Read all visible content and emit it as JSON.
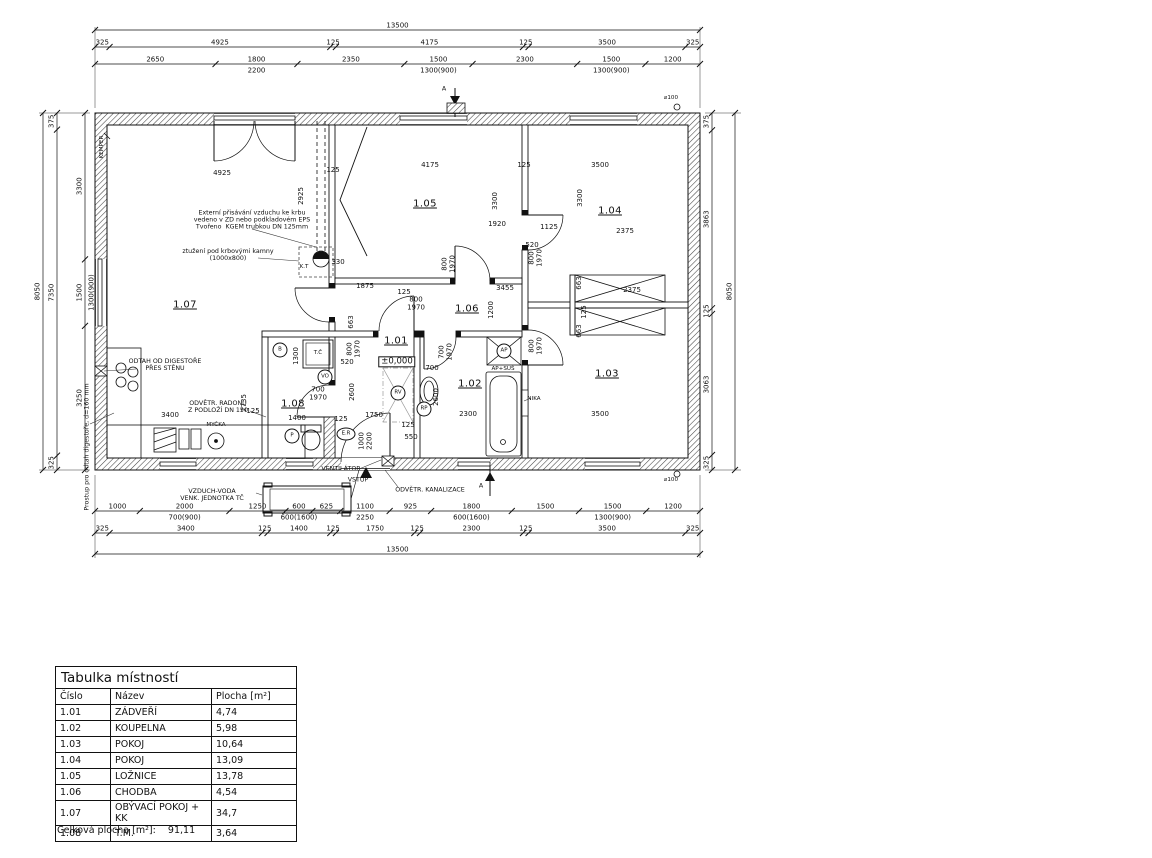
{
  "table": {
    "title": "Tabulka místností",
    "columns": [
      "Číslo",
      "Název",
      "Plocha [m²]"
    ],
    "rows": [
      [
        "1.01",
        "ZÁDVEŘÍ",
        "4,74"
      ],
      [
        "1.02",
        "KOUPELNA",
        "5,98"
      ],
      [
        "1.03",
        "POKOJ",
        "10,64"
      ],
      [
        "1.04",
        "POKOJ",
        "13,09"
      ],
      [
        "1.05",
        "LOŽNICE",
        "13,78"
      ],
      [
        "1.06",
        "CHODBA",
        "4,54"
      ],
      [
        "1.07",
        "OBÝVACÍ POKOJ + KK",
        "34,7"
      ],
      [
        "1.08",
        "T.M.",
        "3,64"
      ]
    ],
    "footer_label": "Celková plocha [m²]:",
    "footer_value": "91,11"
  },
  "drawing": {
    "h_chains": [
      {
        "y": 30,
        "segments": [
          {
            "v": "13500"
          }
        ]
      },
      {
        "y": 47,
        "segments": [
          {
            "v": "325"
          },
          {
            "v": "4925"
          },
          {
            "v": "125"
          },
          {
            "v": "4175"
          },
          {
            "v": "125"
          },
          {
            "v": "3500"
          },
          {
            "v": "325"
          }
        ]
      },
      {
        "y": 64,
        "segments": [
          {
            "v": "2650"
          },
          {
            "v": "1800",
            "sub": "2200"
          },
          {
            "v": "2350"
          },
          {
            "v": "1500",
            "sub": "1300(900)"
          },
          {
            "v": "2300"
          },
          {
            "v": "1500",
            "sub": "1300(900)"
          },
          {
            "v": "1200"
          }
        ]
      },
      {
        "y": 511,
        "segments": [
          {
            "v": "1000"
          },
          {
            "v": "2000",
            "sub": "700(900)"
          },
          {
            "v": "1250"
          },
          {
            "v": "600",
            "sub": "600(1600)"
          },
          {
            "v": "625"
          },
          {
            "v": "1100",
            "sub": "2250"
          },
          {
            "v": "925"
          },
          {
            "v": "1800",
            "sub": "600(1600)"
          },
          {
            "v": "1500"
          },
          {
            "v": "1500",
            "sub": "1300(900)"
          },
          {
            "v": "1200"
          }
        ]
      },
      {
        "y": 533,
        "segments": [
          {
            "v": "325"
          },
          {
            "v": "3400"
          },
          {
            "v": "125"
          },
          {
            "v": "1400"
          },
          {
            "v": "125"
          },
          {
            "v": "1750"
          },
          {
            "v": "125"
          },
          {
            "v": "2300"
          },
          {
            "v": "125"
          },
          {
            "v": "3500"
          },
          {
            "v": "325"
          }
        ]
      },
      {
        "y": 554,
        "segments": [
          {
            "v": "13500"
          }
        ]
      }
    ],
    "v_chains": [
      {
        "x": 43,
        "segments": [
          {
            "v": "8050"
          }
        ]
      },
      {
        "x": 57,
        "segments": [
          {
            "v": "375"
          },
          {
            "v": "7350"
          },
          {
            "v": "325"
          }
        ]
      },
      {
        "x": 85,
        "segments": [
          {
            "v": "3300"
          },
          {
            "v": "1500",
            "sub": "1300(900)"
          },
          {
            "v": "3250"
          }
        ]
      },
      {
        "x": 712,
        "segments": [
          {
            "v": "375"
          },
          {
            "v": "3863"
          },
          {
            "v": "125"
          },
          {
            "v": "3063"
          },
          {
            "v": "325"
          }
        ]
      },
      {
        "x": 735,
        "segments": [
          {
            "v": "8050"
          }
        ]
      }
    ]
  },
  "labels": [
    {
      "x": 185,
      "y": 305,
      "t": "1.07",
      "k": "room"
    },
    {
      "x": 425,
      "y": 204,
      "t": "1.05",
      "k": "room"
    },
    {
      "x": 610,
      "y": 211,
      "t": "1.04",
      "k": "room"
    },
    {
      "x": 467,
      "y": 309,
      "t": "1.06",
      "k": "room"
    },
    {
      "x": 396,
      "y": 341,
      "t": "1.01",
      "k": "room"
    },
    {
      "x": 470,
      "y": 384,
      "t": "1.02",
      "k": "room"
    },
    {
      "x": 607,
      "y": 374,
      "t": "1.03",
      "k": "room"
    },
    {
      "x": 293,
      "y": 404,
      "t": "1.08",
      "k": "room"
    },
    {
      "x": 397,
      "y": 362,
      "t": "±0,000",
      "k": "lvl"
    },
    {
      "x": 222,
      "y": 174,
      "t": "4925",
      "k": "dim"
    },
    {
      "x": 333,
      "y": 171,
      "t": "125",
      "k": "dim"
    },
    {
      "x": 430,
      "y": 166,
      "t": "4175",
      "k": "dim"
    },
    {
      "x": 524,
      "y": 166,
      "t": "125",
      "k": "dim"
    },
    {
      "x": 600,
      "y": 166,
      "t": "3500",
      "k": "dim"
    },
    {
      "x": 302,
      "y": 196,
      "t": "2925",
      "k": "dim",
      "r": 1
    },
    {
      "x": 496,
      "y": 201,
      "t": "3300",
      "k": "dim",
      "r": 1
    },
    {
      "x": 581,
      "y": 198,
      "t": "3300",
      "k": "dim",
      "r": 1
    },
    {
      "x": 497,
      "y": 225,
      "t": "1920",
      "k": "dim"
    },
    {
      "x": 549,
      "y": 228,
      "t": "1125",
      "k": "dim"
    },
    {
      "x": 625,
      "y": 232,
      "t": "2375",
      "k": "dim"
    },
    {
      "x": 532,
      "y": 246,
      "t": "520",
      "k": "dim"
    },
    {
      "x": 338,
      "y": 263,
      "t": "330",
      "k": "dim"
    },
    {
      "x": 449,
      "y": 264,
      "t": "800\n1970",
      "k": "dim",
      "r": 1
    },
    {
      "x": 536,
      "y": 258,
      "t": "800\n1970",
      "k": "dim",
      "r": 1
    },
    {
      "x": 536,
      "y": 346,
      "t": "800\n1970",
      "k": "dim",
      "r": 1
    },
    {
      "x": 365,
      "y": 287,
      "t": "1875",
      "k": "dim"
    },
    {
      "x": 404,
      "y": 293,
      "t": "125",
      "k": "dim"
    },
    {
      "x": 505,
      "y": 289,
      "t": "3455",
      "k": "dim"
    },
    {
      "x": 492,
      "y": 310,
      "t": "1200",
      "k": "dim",
      "r": 1
    },
    {
      "x": 416,
      "y": 304,
      "t": "800\n1970",
      "k": "dim"
    },
    {
      "x": 580,
      "y": 283,
      "t": "663",
      "k": "dim",
      "r": 1
    },
    {
      "x": 585,
      "y": 312,
      "t": "125",
      "k": "dim",
      "r": 1
    },
    {
      "x": 580,
      "y": 331,
      "t": "663",
      "k": "dim",
      "r": 1
    },
    {
      "x": 632,
      "y": 291,
      "t": "2375",
      "k": "dim"
    },
    {
      "x": 352,
      "y": 322,
      "t": "663",
      "k": "dim",
      "r": 1
    },
    {
      "x": 297,
      "y": 356,
      "t": "1300",
      "k": "dim",
      "r": 1
    },
    {
      "x": 347,
      "y": 363,
      "t": "520",
      "k": "dim"
    },
    {
      "x": 354,
      "y": 349,
      "t": "800\n1970",
      "k": "dim",
      "r": 1
    },
    {
      "x": 446,
      "y": 352,
      "t": "700\n1970",
      "k": "dim",
      "r": 1
    },
    {
      "x": 432,
      "y": 369,
      "t": "700",
      "k": "dim"
    },
    {
      "x": 437,
      "y": 397,
      "t": "2600",
      "k": "dim",
      "r": 1
    },
    {
      "x": 353,
      "y": 392,
      "t": "2600",
      "k": "dim",
      "r": 1
    },
    {
      "x": 366,
      "y": 441,
      "t": "1000\n2200",
      "k": "dim",
      "r": 1
    },
    {
      "x": 170,
      "y": 416,
      "t": "3400",
      "k": "dim"
    },
    {
      "x": 253,
      "y": 412,
      "t": "125",
      "k": "dim"
    },
    {
      "x": 245,
      "y": 403,
      "t": "2735",
      "k": "dim",
      "r": 1
    },
    {
      "x": 374,
      "y": 416,
      "t": "1750",
      "k": "dim"
    },
    {
      "x": 408,
      "y": 426,
      "t": "125",
      "k": "dim"
    },
    {
      "x": 411,
      "y": 438,
      "t": "550",
      "k": "dim"
    },
    {
      "x": 468,
      "y": 415,
      "t": "2300",
      "k": "dim"
    },
    {
      "x": 600,
      "y": 415,
      "t": "3500",
      "k": "dim"
    },
    {
      "x": 297,
      "y": 419,
      "t": "1400",
      "k": "dim"
    },
    {
      "x": 341,
      "y": 420,
      "t": "125",
      "k": "dim"
    },
    {
      "x": 318,
      "y": 394,
      "t": "700\n1970",
      "k": "dim"
    },
    {
      "x": 252,
      "y": 221,
      "t": "Externí přisávání vzduchu ke krbu\nvedeno v ZD nebo podkladovém EPS\nTvořeno  KGEM trubkou DN 125mm",
      "k": "ann"
    },
    {
      "x": 228,
      "y": 256,
      "t": "ztužení pod krbovými kamny\n(1000x800)",
      "k": "ann"
    },
    {
      "x": 165,
      "y": 366,
      "t": "ODTAH OD DIGESTOŘE\nPŘES STĚNU",
      "k": "ann"
    },
    {
      "x": 218,
      "y": 408,
      "t": "ODVĚTR. RADONU\nZ PODLOŽÍ DN 150",
      "k": "ann"
    },
    {
      "x": 216,
      "y": 425,
      "t": "MYČKA",
      "k": "ann small"
    },
    {
      "x": 212,
      "y": 496,
      "t": "VZDUCH-VODA\nVENK. JEDNOTKA TČ",
      "k": "ann"
    },
    {
      "x": 341,
      "y": 470,
      "t": "VENTILÁTOR",
      "k": "ann"
    },
    {
      "x": 358,
      "y": 481,
      "t": "VSTUP",
      "k": "ann"
    },
    {
      "x": 430,
      "y": 491,
      "t": "ODVĚTR. KANALIZACE",
      "k": "ann"
    },
    {
      "x": 534,
      "y": 399,
      "t": "NIKA",
      "k": "ann small"
    },
    {
      "x": 503,
      "y": 369,
      "t": "AP+SUŠ",
      "k": "ann small"
    },
    {
      "x": 102,
      "y": 147,
      "t": "KEMPER",
      "k": "ann small",
      "r": 1
    },
    {
      "x": 88,
      "y": 447,
      "t": "Prostup pro odtah digestoře, d=160 mm",
      "k": "ann",
      "r": 1
    },
    {
      "x": 671,
      "y": 98,
      "t": "⌀100",
      "k": "ann small"
    },
    {
      "x": 671,
      "y": 480,
      "t": "⌀100",
      "k": "ann small"
    },
    {
      "x": 304,
      "y": 267,
      "t": "K.T",
      "k": "ann small"
    },
    {
      "x": 318,
      "y": 353,
      "t": "T.Č",
      "k": "ann small"
    },
    {
      "x": 444,
      "y": 90,
      "t": "A",
      "k": "ann"
    },
    {
      "x": 481,
      "y": 487,
      "t": "A",
      "k": "ann"
    },
    {
      "x": 280,
      "y": 350,
      "t": "B",
      "k": "circ"
    },
    {
      "x": 325,
      "y": 377,
      "t": "VO",
      "k": "circ"
    },
    {
      "x": 292,
      "y": 436,
      "t": "P",
      "k": "circ"
    },
    {
      "x": 346,
      "y": 434,
      "t": "E.R",
      "k": "circ wide"
    },
    {
      "x": 424,
      "y": 409,
      "t": "RP",
      "k": "circ"
    },
    {
      "x": 398,
      "y": 393,
      "t": "RV",
      "k": "circ"
    },
    {
      "x": 504,
      "y": 351,
      "t": "AP",
      "k": "circ"
    }
  ]
}
